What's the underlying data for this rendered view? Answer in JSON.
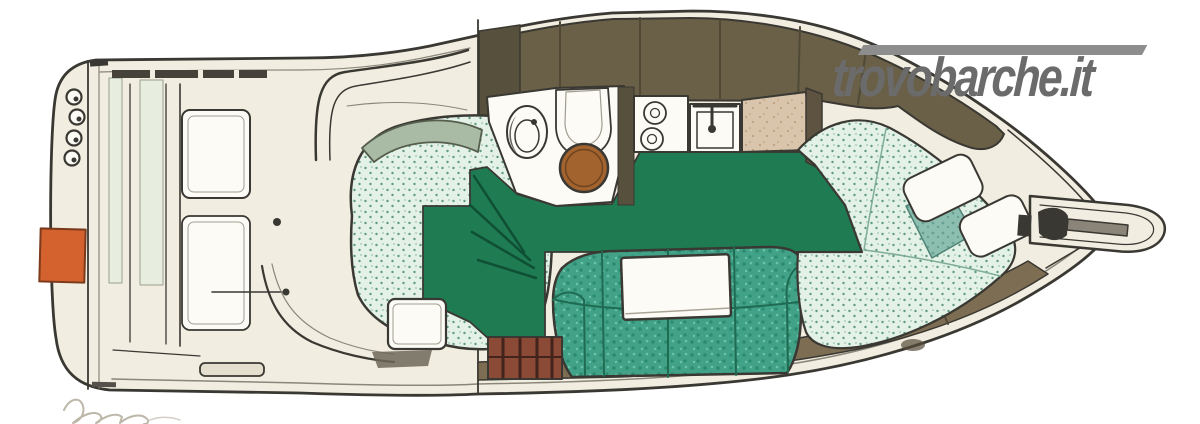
{
  "page": {
    "background": "#ffffff"
  },
  "watermark": {
    "text": "trovobarche.it"
  },
  "illustration": {
    "subject": "hand-drawn top-view floor plan of a motor yacht, bow pointing right",
    "colors": {
      "hull_cream": "#f1ede0",
      "ink": "#3a3832",
      "deck_olive": "#6a6048",
      "deck_olive_dark": "#57503d",
      "walkway_brown": "#7d6d52",
      "floor_green": "#1e7b52",
      "floor_green_dark": "#0f4f34",
      "sofa_teal": "#41a288",
      "sofa_teal_dark": "#2c8a6e",
      "mint": "#e4f1e7",
      "mint_dot": "#5f9a7e",
      "blanket": "#8cbfb0",
      "blanket_dark": "#68a191",
      "tan": "#d9c5ab",
      "tan_dot": "#b9997a",
      "table_wood": "#a2632e",
      "cabinet_rust": "#8a4a36",
      "cabinet_dark": "#43241c",
      "orange": "#d4622f",
      "pale_green": "#e7eee0",
      "white_soft": "#fcfbf6",
      "pulpit_metal": "#8a8578",
      "watermark_gray": "#6b6b6b",
      "watermark_bar": "#8d8d8d",
      "signature_gray": "#b5afa0"
    }
  }
}
